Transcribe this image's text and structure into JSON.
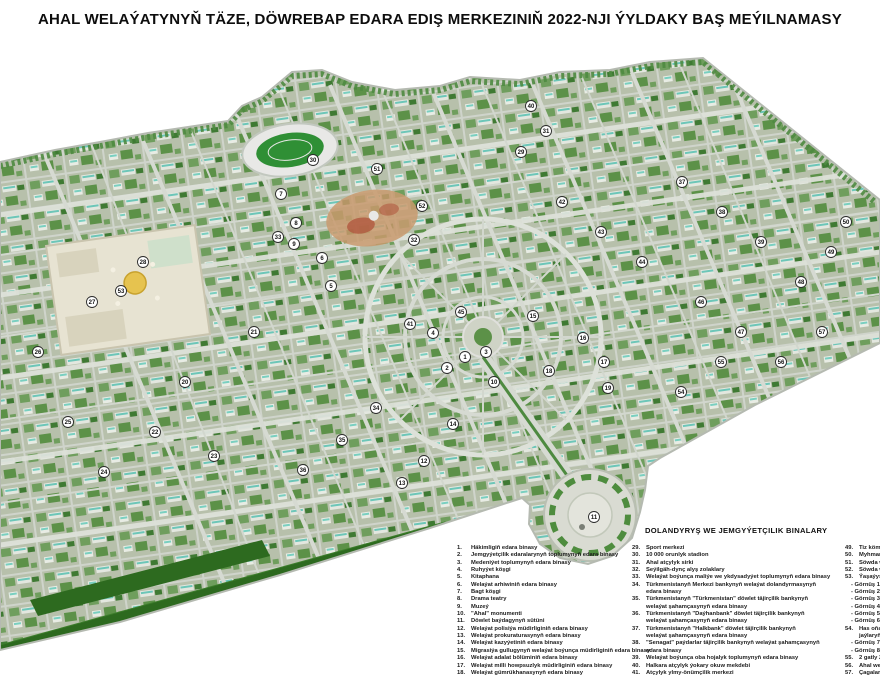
{
  "title": "AHAL WELAÝATYNYŇ TÄZE, DÖWREBAP EDARA EDIŞ MERKEZINIŇ 2022-NJI ÝYLDAKY BAŞ MEÝILNAMASY",
  "legend": {
    "heading": "DOLANDYRYŞ WE JEMGYÝETÇILIK BINALARY",
    "col1": [
      {
        "n": "1.",
        "t": "Häkimligiň edara binasy"
      },
      {
        "n": "2.",
        "t": "Jemgyýetçilik edaralarynyň toplumynyň edara binasy"
      },
      {
        "n": "3.",
        "t": "Medeniýet toplumynyň edara binasy"
      },
      {
        "n": "4.",
        "t": "Ruhyýet köşgi"
      },
      {
        "n": "5.",
        "t": "Kitaphana"
      },
      {
        "n": "6.",
        "t": "Welaýat arhiwiniň edara binasy"
      },
      {
        "n": "7.",
        "t": "Bagt köşgi"
      },
      {
        "n": "8.",
        "t": "Drama teatry"
      },
      {
        "n": "9.",
        "t": "Muzeý"
      },
      {
        "n": "10.",
        "t": "\"Ahal\" monumenti"
      },
      {
        "n": "11.",
        "t": "Döwlet baýdagynyň sütüni"
      },
      {
        "n": "12.",
        "t": "Welaýat polisiýa müdirliginiň edara binasy"
      },
      {
        "n": "13.",
        "t": "Welaýat prokuraturasynyň edara binasy"
      },
      {
        "n": "14.",
        "t": "Welaýat kazyýetiniň edara binasy"
      },
      {
        "n": "15.",
        "t": "Migrasiýa gullugynyň welaýat boýunça müdirliginiň edara binasy"
      },
      {
        "n": "16.",
        "t": "Welaýat adalat bölüminiň edara binasy"
      },
      {
        "n": "17.",
        "t": "Welaýat milli howpsuzlyk müdirliginiň edara binasy"
      },
      {
        "n": "18.",
        "t": "Welaýat gümrükhanasynyň edara binasy"
      }
    ],
    "col2": [
      {
        "n": "29.",
        "t": "Sport merkezi"
      },
      {
        "n": "30.",
        "t": "10 000 orunlyk stadion"
      },
      {
        "n": "31.",
        "t": "Ahal atçylyk sirki"
      },
      {
        "n": "32.",
        "t": "Seýilgäh-dynç alyş zolaklary"
      },
      {
        "n": "33.",
        "t": "Welaýat boýunça maliýe we ykdysadyýet toplumynyň edara binasy"
      },
      {
        "n": "34.",
        "t": "Türkmenistanyň Merkezi bankynyň welaýat dolandyrmasynyň"
      },
      {
        "n": "",
        "t": "edara binasy",
        "cont": true
      },
      {
        "n": "35.",
        "t": "Türkmenistanyň \"Türkmenistan\" döwlet täjirçilik bankynyň"
      },
      {
        "n": "",
        "t": "welaýat şahamçasynyň edara binasy",
        "cont": true
      },
      {
        "n": "36.",
        "t": "Türkmenistanyň \"Daýhanbank\" döwlet täjirçilik bankynyň"
      },
      {
        "n": "",
        "t": "welaýat şahamçasynyň edara binasy",
        "cont": true
      },
      {
        "n": "37.",
        "t": "Türkmenistanyň \"Halkbank\" döwlet täjirçilik bankynyň"
      },
      {
        "n": "",
        "t": "welaýat şahamçasynyň edara binasy",
        "cont": true
      },
      {
        "n": "38.",
        "t": "\"Senagat\" paýdarlar täjirçilik bankynyň welaýat şahamçasynyň"
      },
      {
        "n": "",
        "t": "edara binasy",
        "cont": true
      },
      {
        "n": "39.",
        "t": "Welaýat boýunça oba hojalyk toplumynyň edara binasy"
      },
      {
        "n": "40.",
        "t": "Halkara atçylyk ýokary okuw mekdebi"
      },
      {
        "n": "41.",
        "t": "Atçylyk ylmy-önümçilik merkezi"
      }
    ],
    "col3": [
      {
        "n": "49.",
        "t": "Tiz kömek me"
      },
      {
        "n": "50.",
        "t": "Myhmanhana"
      },
      {
        "n": "51.",
        "t": "Söwda we dy"
      },
      {
        "n": "52.",
        "t": "Söwda we hyz"
      },
      {
        "n": "53.",
        "t": "Ýaşaýyş jaýlar"
      },
      {
        "n": "",
        "t": "- Görnüş 1 - 9",
        "sub": true
      },
      {
        "n": "",
        "t": "- Görnüş 2 - 7",
        "sub": true
      },
      {
        "n": "",
        "t": "- Görnüş 3 - 7",
        "sub": true
      },
      {
        "n": "",
        "t": "- Görnüş 4 - 7",
        "sub": true
      },
      {
        "n": "",
        "t": "- Görnüş 5 - 9",
        "sub": true
      },
      {
        "n": "",
        "t": "- Görnüş 6 - 9",
        "sub": true
      },
      {
        "n": "54.",
        "t": "Has oňaýly w"
      },
      {
        "n": "",
        "t": "jaýlaryň topl",
        "cont": true
      },
      {
        "n": "",
        "t": "- Görnüş 7 - 7",
        "sub": true
      },
      {
        "n": "",
        "t": "- Görnüş 8 - 7",
        "sub": true
      },
      {
        "n": "55.",
        "t": "2 gatly 2 öýli j"
      },
      {
        "n": "56.",
        "t": "Ahal welaýat"
      },
      {
        "n": "57.",
        "t": "Çagalar dü"
      }
    ]
  },
  "map": {
    "description": "Aerial perspective master plan of the new administrative centre of Ahal province, 2022",
    "colors": {
      "base": "#b7c0ab",
      "trees_dark": "#4e7d3f",
      "trees_mid": "#6f9e5d",
      "road": "#dde1d9",
      "building": "#e3e7df",
      "teal_roof": "#6cc6b8",
      "fields": "#2d6a1f",
      "stadium_pitch": "#2f8f35",
      "plaza": "#d9dbd2",
      "mosque_plaza": "#e7e3d2",
      "gold_dome": "#e6c34f",
      "park_sand": "#c99a6e"
    },
    "markers": [
      {
        "n": 1,
        "x": 465,
        "y": 357
      },
      {
        "n": 2,
        "x": 447,
        "y": 368
      },
      {
        "n": 3,
        "x": 486,
        "y": 352
      },
      {
        "n": 4,
        "x": 433,
        "y": 333
      },
      {
        "n": 5,
        "x": 331,
        "y": 286
      },
      {
        "n": 6,
        "x": 322,
        "y": 258
      },
      {
        "n": 7,
        "x": 281,
        "y": 194
      },
      {
        "n": 8,
        "x": 296,
        "y": 223
      },
      {
        "n": 9,
        "x": 294,
        "y": 244
      },
      {
        "n": 10,
        "x": 494,
        "y": 382
      },
      {
        "n": 11,
        "x": 594,
        "y": 517
      },
      {
        "n": 12,
        "x": 424,
        "y": 461
      },
      {
        "n": 13,
        "x": 402,
        "y": 483
      },
      {
        "n": 14,
        "x": 453,
        "y": 424
      },
      {
        "n": 15,
        "x": 533,
        "y": 316
      },
      {
        "n": 16,
        "x": 583,
        "y": 338
      },
      {
        "n": 17,
        "x": 604,
        "y": 362
      },
      {
        "n": 18,
        "x": 549,
        "y": 371
      },
      {
        "n": 19,
        "x": 608,
        "y": 388
      },
      {
        "n": 20,
        "x": 185,
        "y": 382
      },
      {
        "n": 21,
        "x": 254,
        "y": 332
      },
      {
        "n": 22,
        "x": 155,
        "y": 432
      },
      {
        "n": 23,
        "x": 214,
        "y": 456
      },
      {
        "n": 24,
        "x": 104,
        "y": 472
      },
      {
        "n": 25,
        "x": 68,
        "y": 422
      },
      {
        "n": 26,
        "x": 38,
        "y": 352
      },
      {
        "n": 27,
        "x": 92,
        "y": 302
      },
      {
        "n": 28,
        "x": 143,
        "y": 262
      },
      {
        "n": 29,
        "x": 521,
        "y": 152
      },
      {
        "n": 30,
        "x": 313,
        "y": 160
      },
      {
        "n": 31,
        "x": 546,
        "y": 131
      },
      {
        "n": 32,
        "x": 414,
        "y": 240
      },
      {
        "n": 33,
        "x": 278,
        "y": 237
      },
      {
        "n": 34,
        "x": 376,
        "y": 408
      },
      {
        "n": 35,
        "x": 342,
        "y": 440
      },
      {
        "n": 36,
        "x": 303,
        "y": 470
      },
      {
        "n": 37,
        "x": 682,
        "y": 182
      },
      {
        "n": 38,
        "x": 722,
        "y": 212
      },
      {
        "n": 39,
        "x": 761,
        "y": 242
      },
      {
        "n": 40,
        "x": 531,
        "y": 106
      },
      {
        "n": 41,
        "x": 410,
        "y": 324
      },
      {
        "n": 42,
        "x": 562,
        "y": 202
      },
      {
        "n": 43,
        "x": 601,
        "y": 232
      },
      {
        "n": 44,
        "x": 642,
        "y": 262
      },
      {
        "n": 45,
        "x": 461,
        "y": 312
      },
      {
        "n": 46,
        "x": 701,
        "y": 302
      },
      {
        "n": 47,
        "x": 741,
        "y": 332
      },
      {
        "n": 48,
        "x": 801,
        "y": 282
      },
      {
        "n": 49,
        "x": 831,
        "y": 252
      },
      {
        "n": 50,
        "x": 846,
        "y": 222
      },
      {
        "n": 51,
        "x": 377,
        "y": 169
      },
      {
        "n": 52,
        "x": 422,
        "y": 206
      },
      {
        "n": 53,
        "x": 121,
        "y": 291
      },
      {
        "n": 54,
        "x": 681,
        "y": 392
      },
      {
        "n": 55,
        "x": 721,
        "y": 362
      },
      {
        "n": 56,
        "x": 781,
        "y": 362
      },
      {
        "n": 57,
        "x": 822,
        "y": 332
      }
    ]
  }
}
